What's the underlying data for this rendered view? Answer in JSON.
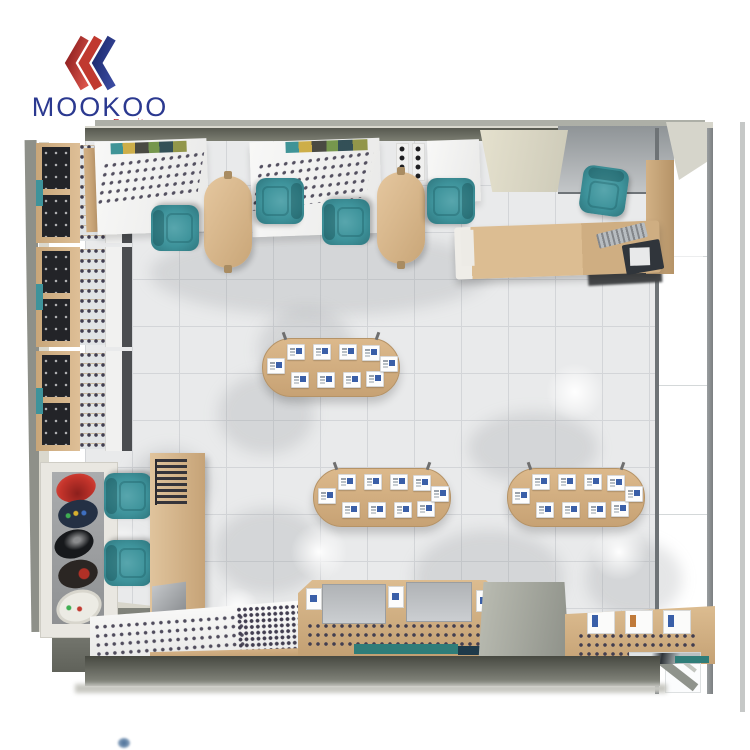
{
  "brand": {
    "name": "MOOKOO",
    "tagline": "Furniture"
  },
  "colors": {
    "brand_blue": "#2b3990",
    "brand_red": "#c1272d",
    "teal": "#3e939b",
    "teal_dark": "#2e757d",
    "wood": "#d4b083",
    "wood_dark": "#c2a074",
    "wall_olive": "#6e7064",
    "floor": "#e9eaeb",
    "floor_line": "#d3d5d8",
    "panel_dark": "#2a2b2e",
    "counter_white": "#f5f5f4",
    "glass": "#eef0f1",
    "frame_gray": "#75797c",
    "mat_teal": "#2f7d79",
    "card_blue": "#3a5fa8",
    "eyewear_dark": "#423e50",
    "gray_panel": "#b4b7ba"
  },
  "scene": {
    "description": "Top-down 3D render of an optical eyewear shop interior floor plan",
    "areas": {
      "left_wall_displays": {
        "label": "wall eyewear display units",
        "count": 3
      },
      "fitting_stations": {
        "label": "optical fitting tables with teal chairs",
        "tables": 2,
        "chairs": 4
      },
      "cashier": {
        "label": "cashier desk",
        "items": [
          "L-shaped desk",
          "keyboard",
          "monitor",
          "teal chair"
        ]
      },
      "center_display_tables": {
        "label": "oval display tables with product cards",
        "count": 3,
        "cards_per_table": 10
      },
      "mirror_station": {
        "label": "mirror cabinet with two teal chairs"
      },
      "poster_tower": {
        "label": "sunglasses poster display"
      },
      "front_counters": {
        "label": "window display counters",
        "count": 3
      },
      "storefront": {
        "label": "glass storefront wall"
      }
    }
  }
}
